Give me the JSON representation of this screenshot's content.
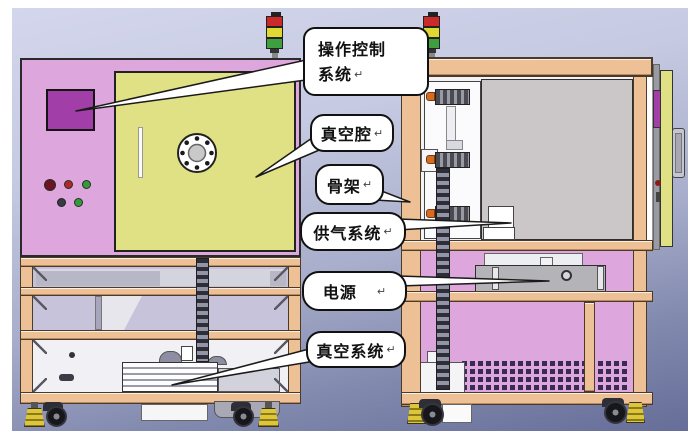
{
  "colors": {
    "pink": "#dda6dd",
    "purple": "#a23ea8",
    "yellow": "#e0e184",
    "tan": "#eec096",
    "gray-panel": "#cbc7c9",
    "power-gray": "#b4b4b8",
    "signal-red": "#cc2a2a",
    "signal-yellow": "#e0d832",
    "signal-green": "#3f9e3f",
    "foot-yellow": "#d8c235"
  },
  "callouts": {
    "control": {
      "line1": "操作控制",
      "line2": "系统",
      "mark": "↵"
    },
    "chamber": {
      "text": "真空腔",
      "mark": "↵"
    },
    "frame": {
      "text": "骨架",
      "mark": "↵"
    },
    "gas": {
      "text": "供气系统",
      "mark": "↵"
    },
    "power": {
      "text": "电源",
      "mark": "↵"
    },
    "vacuum": {
      "text": "真空系统",
      "mark": "↵"
    }
  }
}
